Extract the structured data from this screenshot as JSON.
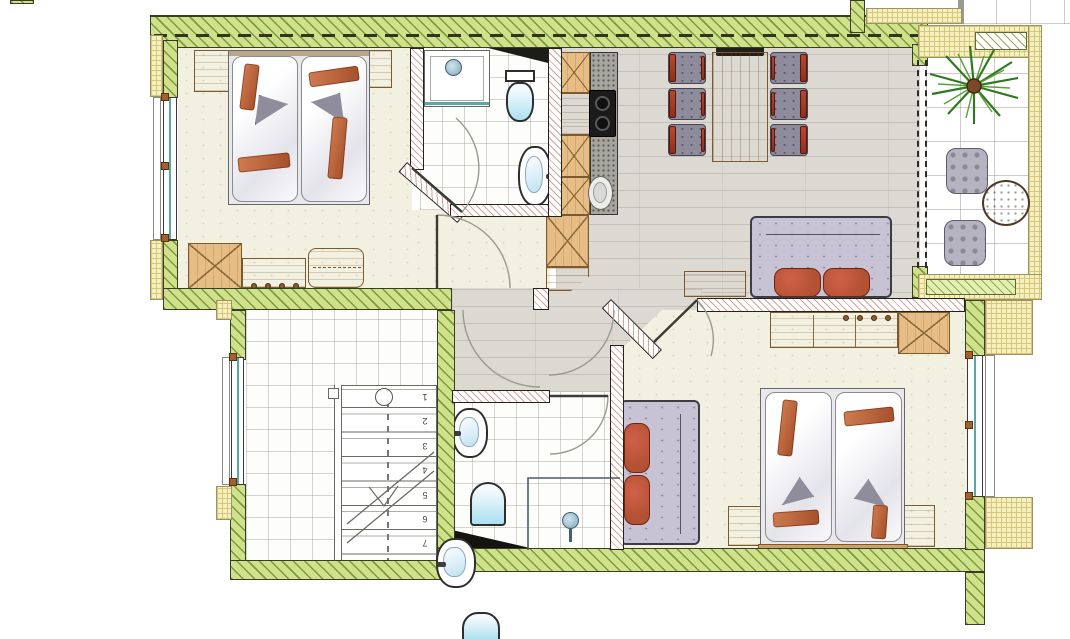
{
  "document": {
    "title": "Apartment floor plan"
  },
  "stairs": {
    "steps": [
      "1",
      "2",
      "3",
      "4",
      "5",
      "6",
      "7",
      "8"
    ]
  },
  "palette": {
    "wall-green": "#cfe18b",
    "wall-green-line": "#7e9a3f",
    "sill-yellow": "#f6efbe",
    "sill-yellow-line": "#d5c87e",
    "floor-wood": "#dcd9d2",
    "floor-cream": "#f2f1e1",
    "wood": "#e6bd84",
    "wood-dark": "#7c5a2e",
    "rust": "#b35232",
    "chair-gray": "#8e8c9c",
    "sofa-gray": "#c8c3d4",
    "water-blue": "#bfe2f2",
    "glass-teal": "#57a8a0",
    "counter-gray": "#a6a69e",
    "plant-green": "#3c8428",
    "table-brown": "#8f6e56",
    "cooktop": "#1b1b1b",
    "line-dark": "#2e2e26"
  },
  "legend": {
    "rooms": [
      "bedroom-1",
      "bathroom-1",
      "kitchen-dining-living",
      "balcony",
      "hall",
      "stairwell",
      "bathroom-2",
      "bedroom-2"
    ],
    "bedroom1_items": [
      "double-bed",
      "nightstand",
      "nightstand",
      "wardrobe",
      "dresser",
      "chest"
    ],
    "kitchen_items": [
      "cabinet-row",
      "counter",
      "cooktop",
      "sink"
    ],
    "dining_items": [
      "dining-table",
      "bench",
      "chair",
      "chair",
      "chair",
      "chair",
      "chair",
      "chair"
    ],
    "living_items": [
      "sofa",
      "sideboard"
    ],
    "balcony_items": [
      "palm-plant",
      "lounge-chair",
      "lounge-chair",
      "round-table"
    ],
    "bathroom1_items": [
      "shower",
      "toilet",
      "washbasin"
    ],
    "bathroom2_items": [
      "washbasin",
      "toilet",
      "shower"
    ],
    "bedroom2_items": [
      "double-bed",
      "nightstand",
      "nightstand",
      "sofa",
      "sideboard",
      "wardrobe"
    ],
    "extra_fixtures": [
      "washbasin",
      "toilet-cropped"
    ]
  }
}
